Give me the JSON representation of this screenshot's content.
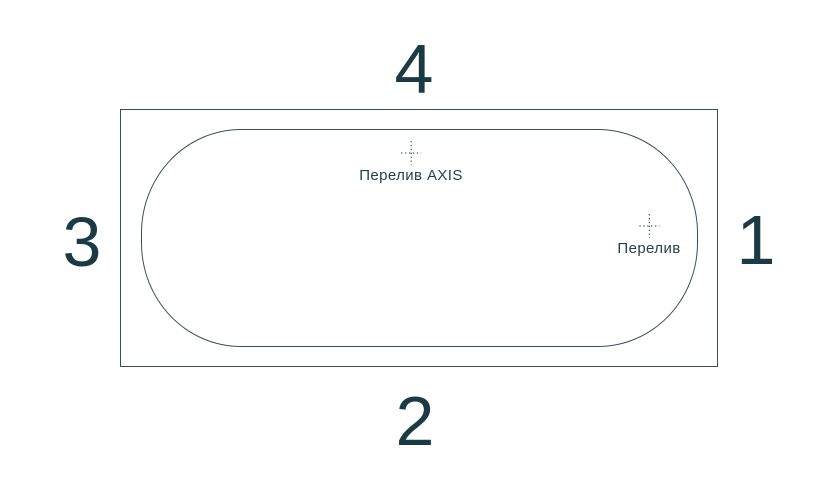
{
  "diagram": {
    "sides": {
      "top": "4",
      "right": "1",
      "bottom": "2",
      "left": "3"
    },
    "markers": [
      {
        "id": "overflow-axis",
        "label": "Перелив AXIS"
      },
      {
        "id": "overflow",
        "label": "Перелив"
      }
    ],
    "colors": {
      "background": "#ffffff",
      "line": "#3b4e57",
      "text": "#1c3a44"
    }
  }
}
